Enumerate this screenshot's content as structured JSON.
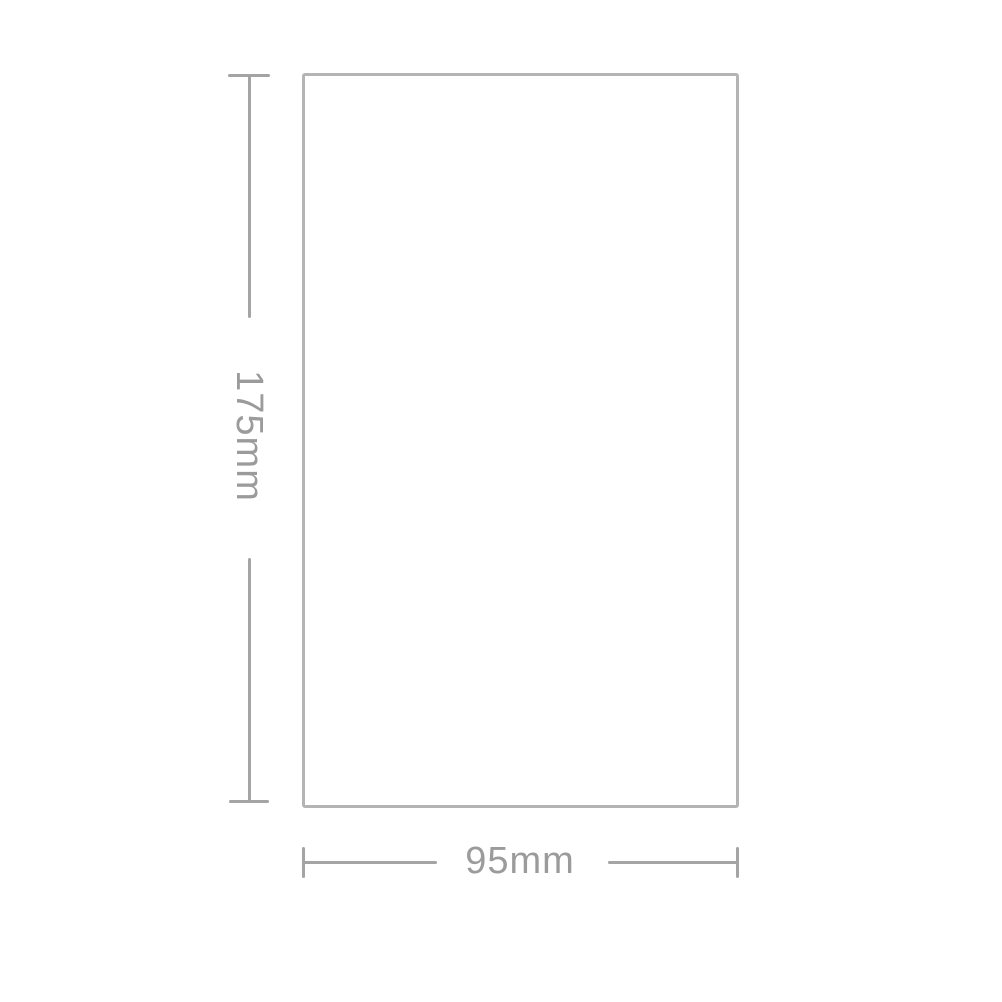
{
  "diagram": {
    "height_dimension": {
      "label": "175mm"
    },
    "width_dimension": {
      "label": "95mm"
    }
  },
  "colors": {
    "background": "#ffffff",
    "rectangle_outline": "#b4b4b4",
    "dimension_line": "#a4a4a4",
    "label_text": "#9b9b9b"
  }
}
